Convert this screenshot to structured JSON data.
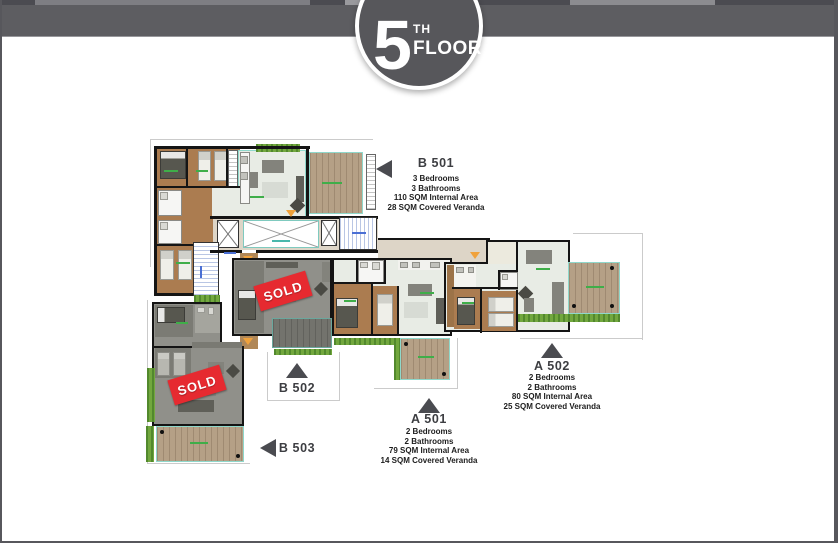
{
  "header": {
    "floor_number": "5",
    "floor_ordinal": "TH",
    "floor_word": "FLOOR"
  },
  "sold_label": "SOLD",
  "units": [
    {
      "id": "b501",
      "label": "B 501",
      "pointer": "left",
      "details": [
        "3 Bedrooms",
        "3 Bathrooms",
        "110 SQM Internal Area",
        "28 SQM Covered Veranda"
      ]
    },
    {
      "id": "b502",
      "label": "B 502",
      "pointer": "up",
      "sold": true,
      "details": []
    },
    {
      "id": "b503",
      "label": "B 503",
      "pointer": "left",
      "sold": true,
      "details": []
    },
    {
      "id": "a501",
      "label": "A 501",
      "pointer": "up",
      "details": [
        "2 Bedrooms",
        "2 Bathrooms",
        "79 SQM Internal Area",
        "14 SQM Covered Veranda"
      ]
    },
    {
      "id": "a502",
      "label": "A 502",
      "pointer": "up",
      "details": [
        "2 Bedrooms",
        "2 Bathrooms",
        "80 SQM Internal Area",
        "25 SQM Covered Veranda"
      ]
    }
  ],
  "icons": {
    "unit_pointer_left": "triangle-left",
    "unit_pointer_up": "triangle-up"
  },
  "colors": {
    "sold_red": "#e62a30",
    "header_gray": "#5d5d61",
    "badge_gray": "#57575b",
    "plan_green": "#3fae49",
    "deck_tan": "#b5a086",
    "wood_brown": "#ab7c50"
  }
}
